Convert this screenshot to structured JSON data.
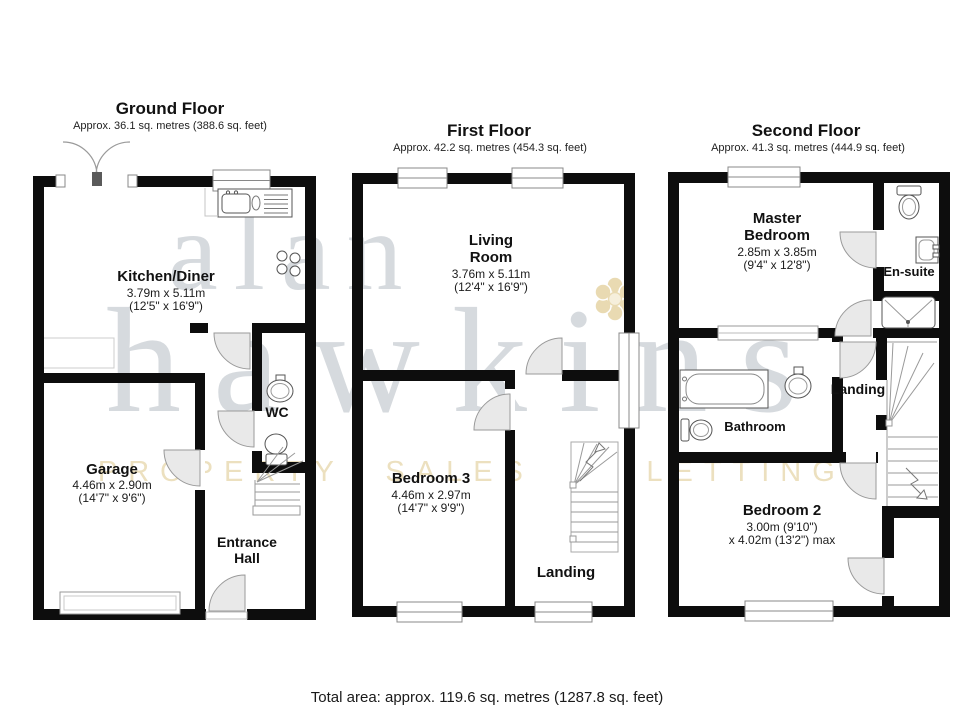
{
  "watermark": {
    "word1": "alan",
    "word2": "hawkins",
    "tagline": "PROPERTY SALES & LETTINGS",
    "accent_color": "#e7d6a8",
    "gray_color": "#d6dade"
  },
  "footer": {
    "total_area": "Total area: approx. 119.6 sq. metres (1287.8 sq. feet)"
  },
  "ground_floor": {
    "title": "Ground Floor",
    "subtitle": "Approx. 36.1 sq. metres (388.6 sq. feet)",
    "kitchen": {
      "name": "Kitchen/Diner",
      "dims": "3.79m x 5.11m",
      "dims_ft": "(12'5\" x 16'9\")"
    },
    "garage": {
      "name": "Garage",
      "dims": "4.46m x 2.90m",
      "dims_ft": "(14'7\" x 9'6\")"
    },
    "wc": {
      "name": "WC"
    },
    "entrance_hall": {
      "name_line1": "Entrance",
      "name_line2": "Hall"
    }
  },
  "first_floor": {
    "title": "First Floor",
    "subtitle": "Approx. 42.2 sq. metres (454.3 sq. feet)",
    "living_room": {
      "name_line1": "Living",
      "name_line2": "Room",
      "dims": "3.76m x 5.11m",
      "dims_ft": "(12'4\" x 16'9\")"
    },
    "bedroom3": {
      "name": "Bedroom 3",
      "dims": "4.46m x 2.97m",
      "dims_ft": "(14'7\" x 9'9\")"
    },
    "landing": {
      "name": "Landing"
    }
  },
  "second_floor": {
    "title": "Second Floor",
    "subtitle": "Approx. 41.3 sq. metres (444.9 sq. feet)",
    "master_bedroom": {
      "name_line1": "Master",
      "name_line2": "Bedroom",
      "dims": "2.85m x 3.85m",
      "dims_ft": "(9'4\" x 12'8\")"
    },
    "ensuite": {
      "name": "En-suite"
    },
    "bathroom": {
      "name": "Bathroom"
    },
    "landing": {
      "name": "Landing"
    },
    "bedroom2": {
      "name": "Bedroom 2",
      "dims": "3.00m (9'10\")",
      "dims_ft": "x 4.02m (13'2\") max"
    }
  }
}
